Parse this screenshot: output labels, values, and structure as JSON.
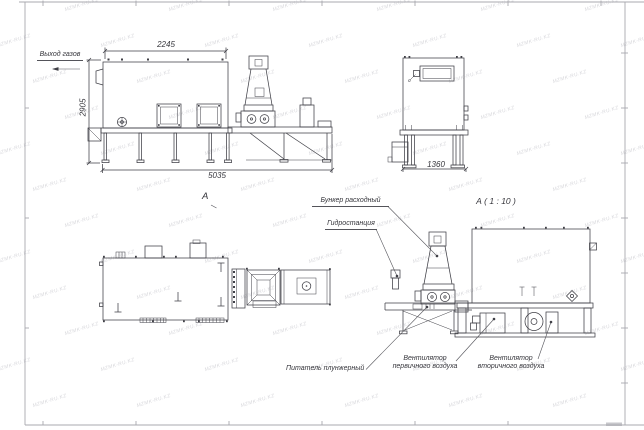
{
  "watermark": {
    "text": "MZMK-RU.KZ",
    "color": "#d8d8dc"
  },
  "callouts": {
    "gas_outlet": "Выход газов",
    "bunker": "Бункер расходный",
    "hydrostation": "Гидростанция",
    "feeder": "Питатель плунжерный",
    "primary_fan": {
      "line1": "Вентилятор",
      "line2": "первичного воздуха"
    },
    "secondary_fan": {
      "line1": "Вентилятор",
      "line2": "вторичного воздуха"
    }
  },
  "view_markers": {
    "view_arrow": "А",
    "detail_title": "А ( 1 : 10 )"
  },
  "dimensions": {
    "front_top_width": "2245",
    "front_height": "2905",
    "front_length": "5035",
    "side_width": "1360"
  },
  "colors": {
    "line": "#3f3f46",
    "dim": "#54545a",
    "text": "#35353b",
    "frame": "#a9a9af",
    "watermark": "#d8d8dc",
    "background": "#ffffff"
  }
}
